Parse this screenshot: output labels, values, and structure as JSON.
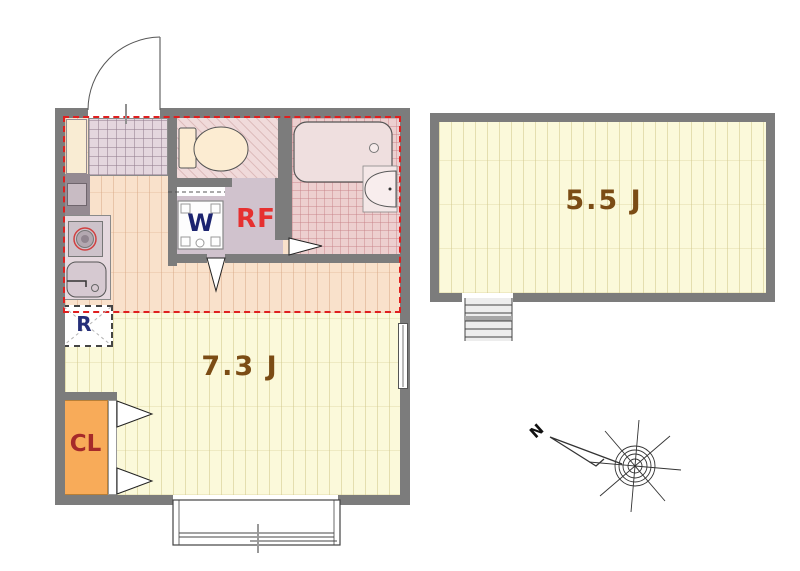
{
  "left_unit": {
    "main_room_label": "7.3 J",
    "closet_label": "CL",
    "fridge_label": "R",
    "washer_label": "W",
    "loft_area_label": "RF"
  },
  "right_unit": {
    "room_label": "5.5 J"
  },
  "compass": {
    "north_label": "N"
  },
  "colors": {
    "wall": "#7c7c7c",
    "loft_outline_dash": "#df1f1f",
    "room_floor": "#fbf9da",
    "kitchen_floor": "#f9e1cb",
    "closet_fill": "#f8ab59",
    "area_label_text": "#7b4c15",
    "washer_text": "#1c2470",
    "loft_text": "#e63030",
    "closet_text": "#a62a2a",
    "fridge_text": "#252e78"
  }
}
